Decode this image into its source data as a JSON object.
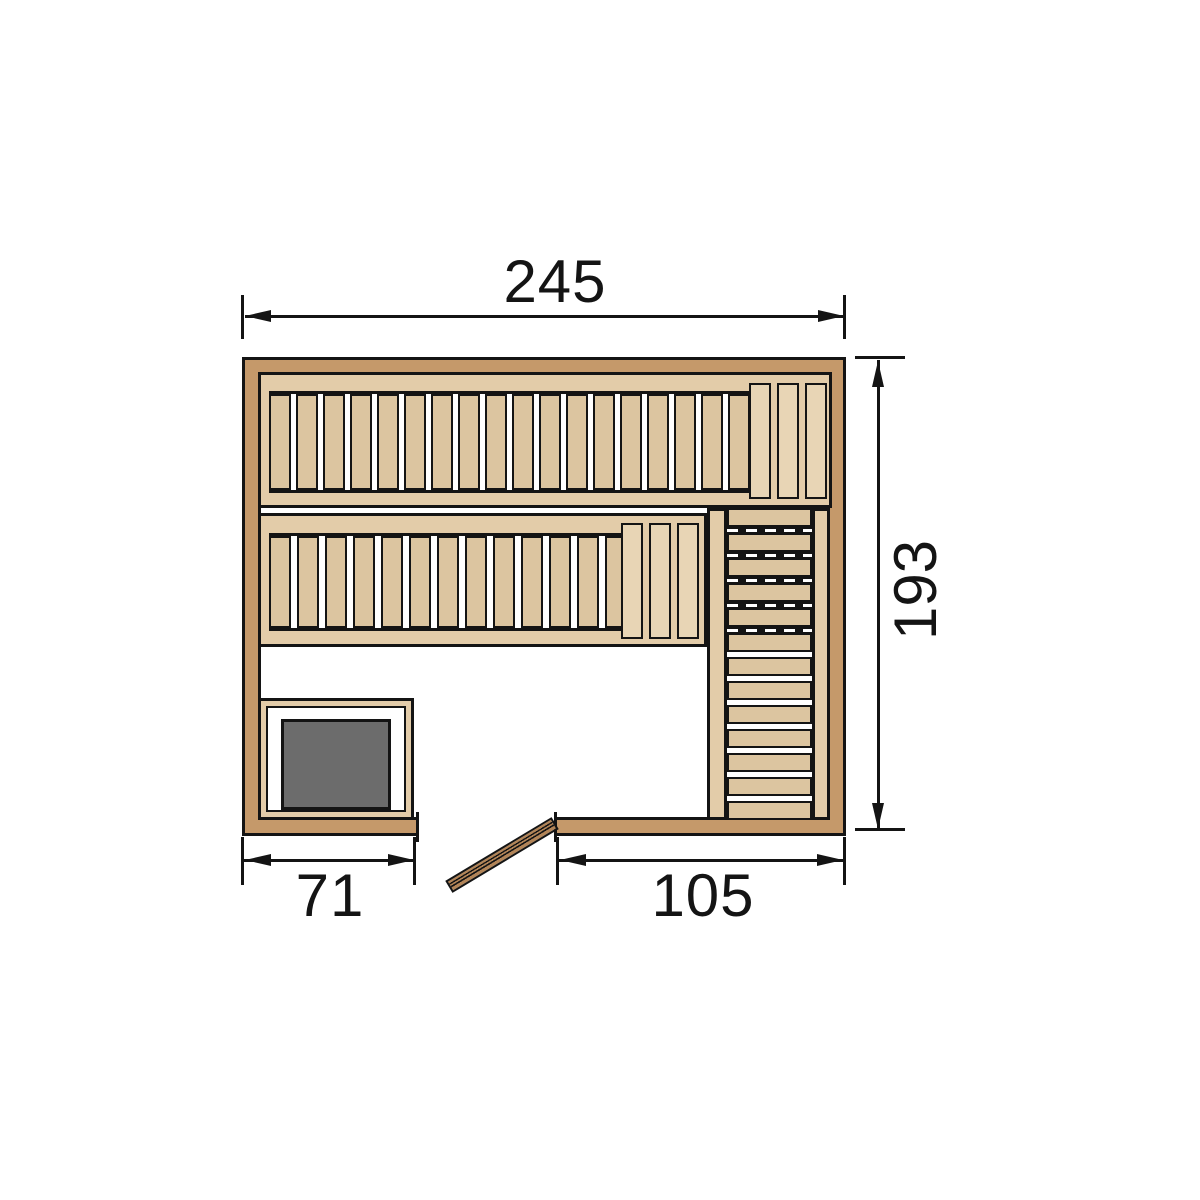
{
  "title": "Sauna floor plan (top view)",
  "dimensions": {
    "overall_width": "245",
    "overall_depth": "193",
    "left_section_width": "71",
    "right_section_width": "105"
  },
  "colors": {
    "wall": "#C5996A",
    "wood_rail": "#E3CCA9",
    "wood_slat": "#DCC5A0",
    "wood_headrest": "#E8D5B5",
    "stove": "#6C6C6C",
    "door": "#B28457",
    "line": "#141414",
    "background": "#FFFFFF"
  },
  "benches": {
    "upper": {
      "slats": 18,
      "headrest_slats": 3
    },
    "lower": {
      "slats": 13,
      "headrest_slats": 3
    },
    "side": {
      "boards": 13,
      "dash_gaps": 5
    }
  }
}
